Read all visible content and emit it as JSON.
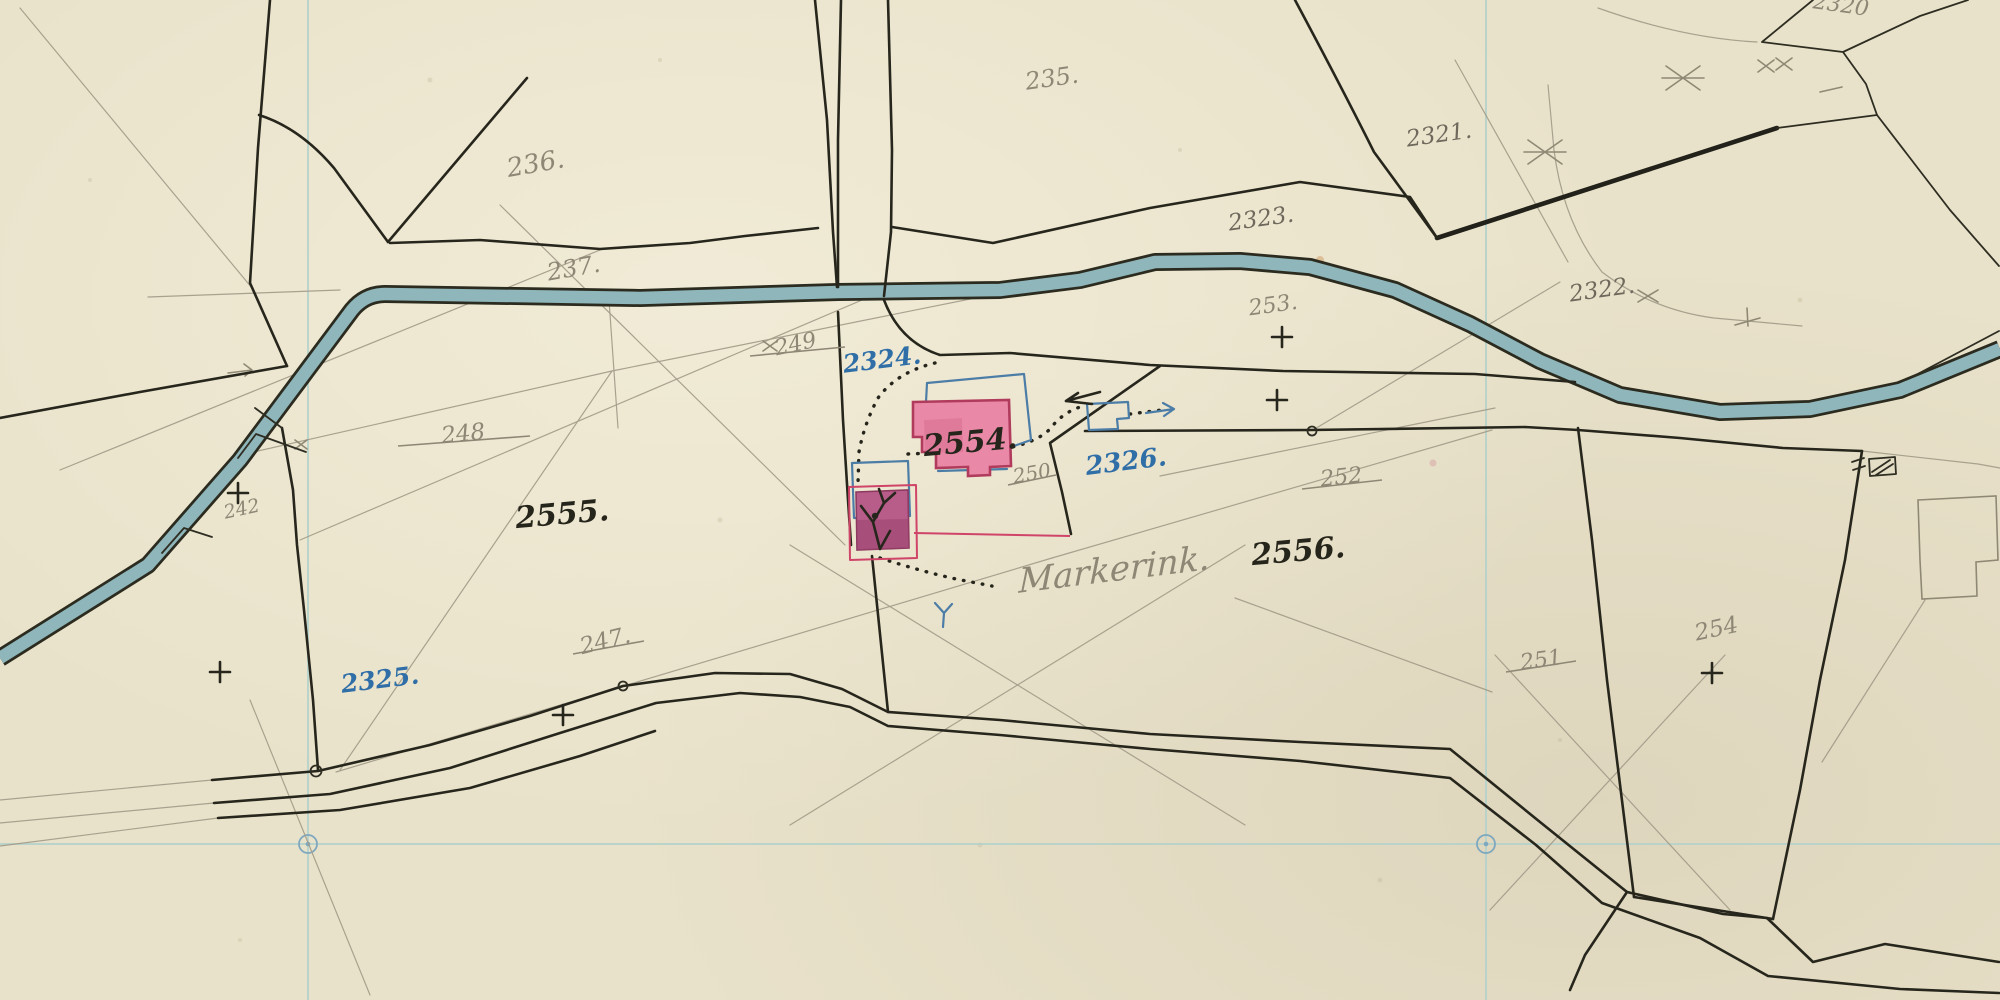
{
  "map": {
    "kind": "historical cadastral field sketch",
    "farm_name": "Markerink.",
    "palette": {
      "paper": "#e9e2ca",
      "water_fill": "#8fb6ba",
      "ink_line": "#27261c",
      "pencil_line": "#a49d8a",
      "blue_ink": "#2f6ea6",
      "building_fill_pink": "#e989a7",
      "building_fill_dark_pink": "#b85c8a",
      "building_outline_red": "#cf4468",
      "old_outline_blue": "#4c7da7",
      "grid_blue": "#b5d2cb"
    },
    "parcels": {
      "new_ink_numbers": [
        "2554.",
        "2555.",
        "2556."
      ],
      "new_blue_numbers": [
        "2324.",
        "2325.",
        "2326."
      ],
      "pencil_numbers": [
        "235.",
        "236.",
        "237.",
        "2320",
        "2321.",
        "2322.",
        "2323.",
        "253.",
        "254",
        "242"
      ],
      "struck_out_numbers": [
        "249",
        "248",
        "247.",
        "250",
        "252",
        "251"
      ]
    }
  },
  "labels": [
    {
      "text": "235.",
      "kind": "pencil"
    },
    {
      "text": "236.",
      "kind": "pencil"
    },
    {
      "text": "237.",
      "kind": "pencil"
    },
    {
      "text": "2320",
      "kind": "pencil"
    },
    {
      "text": "2321.",
      "kind": "graphite"
    },
    {
      "text": "2322.",
      "kind": "graphite"
    },
    {
      "text": "2323.",
      "kind": "graphite"
    },
    {
      "text": "249",
      "kind": "pencil-struck"
    },
    {
      "text": "248",
      "kind": "pencil-struck"
    },
    {
      "text": "247.",
      "kind": "pencil-struck"
    },
    {
      "text": "250",
      "kind": "pencil-struck"
    },
    {
      "text": "252",
      "kind": "pencil-struck"
    },
    {
      "text": "251",
      "kind": "pencil-struck"
    },
    {
      "text": "253.",
      "kind": "pencil"
    },
    {
      "text": "254",
      "kind": "pencil"
    },
    {
      "text": "242",
      "kind": "pencil"
    },
    {
      "text": "2324.",
      "kind": "blue-ink"
    },
    {
      "text": "2325.",
      "kind": "blue-ink"
    },
    {
      "text": "2326.",
      "kind": "blue-ink"
    },
    {
      "text": "2554.",
      "kind": "black-ink"
    },
    {
      "text": "2555.",
      "kind": "black-ink"
    },
    {
      "text": "2556.",
      "kind": "black-ink"
    },
    {
      "text": "Markerink.",
      "kind": "pencil-script"
    }
  ]
}
